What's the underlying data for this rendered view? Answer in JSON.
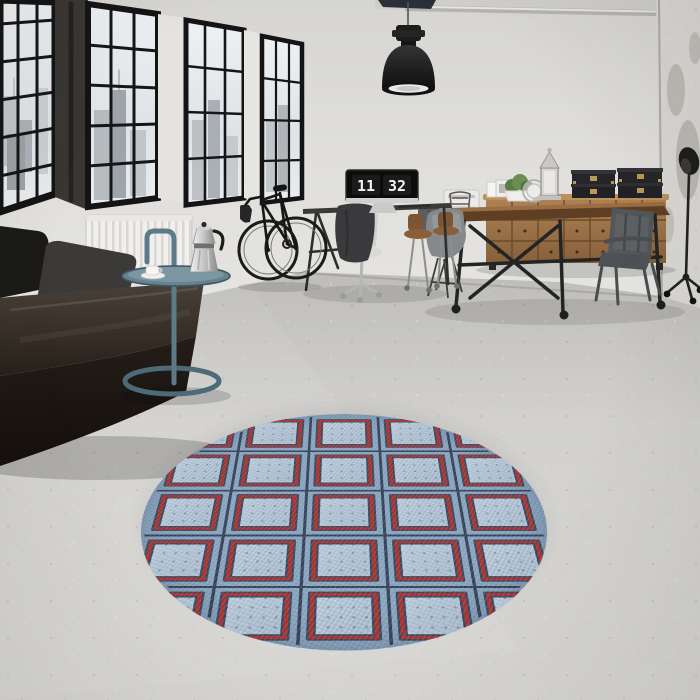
{
  "scene": {
    "type": "photograph",
    "setting": "industrial loft living room with round rug"
  },
  "monitor_clock": {
    "hours": "11",
    "minutes": "32"
  },
  "colors": {
    "wall": "#dcdbd8",
    "floor": "#cfcecb",
    "window_frame": "#161616",
    "sofa_leather": "#241e1a",
    "side_table_teal": "#5d7a89",
    "rug_blue": "#a2b8cb",
    "rug_red": "#a93531",
    "rug_navy": "#36445c",
    "sideboard_wood": "#9c7347",
    "box_brass": "#b89a52",
    "lamp_black": "#1d1d1d"
  }
}
